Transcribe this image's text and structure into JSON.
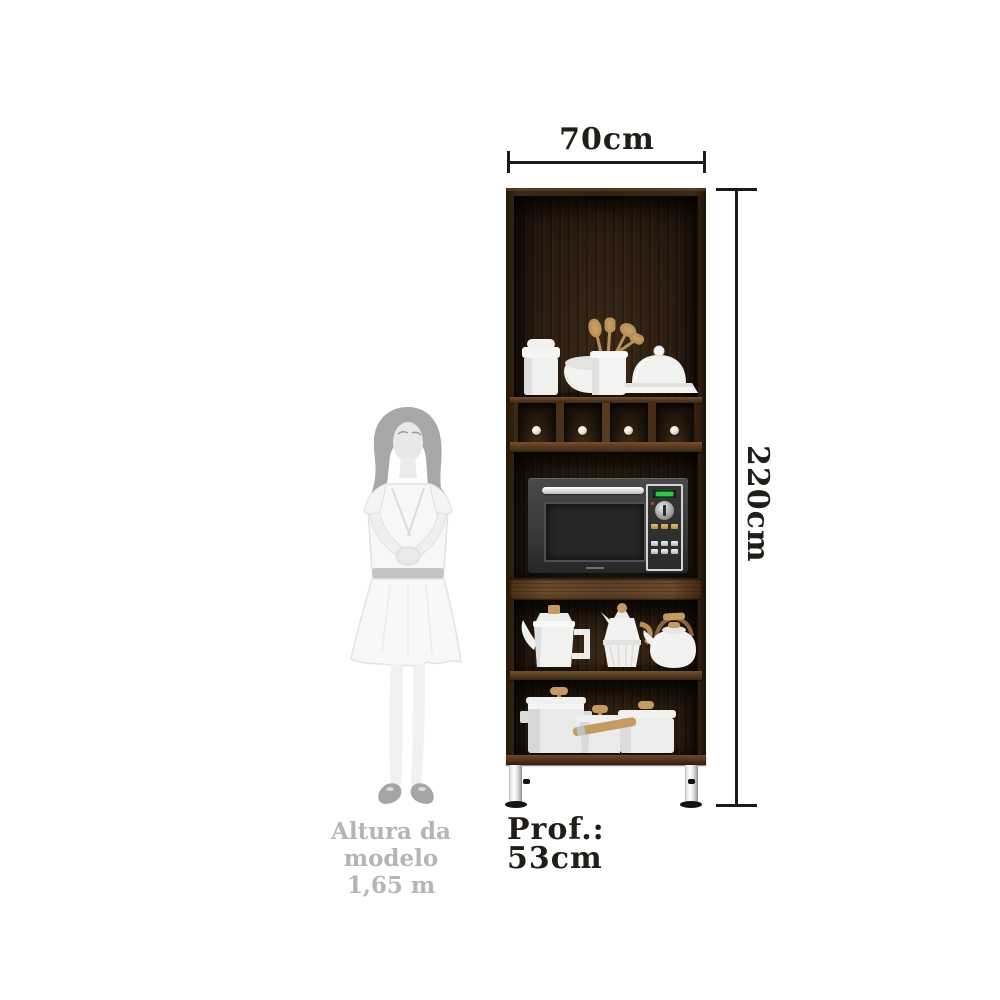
{
  "annotations": {
    "width_label": "70cm",
    "height_label": "220cm",
    "depth_label": "Prof.:",
    "depth_value": "53cm"
  },
  "model": {
    "caption_line1": "Altura da modelo",
    "caption_line2": "1,65 m"
  },
  "cabinet": {
    "cubby_knob_count": 4,
    "top_shelf_items": [
      "ceramic-canister",
      "ceramic-bowl",
      "utensil-crock-with-wooden-utensils",
      "butter-dish"
    ],
    "middle_item": "microwave-oven",
    "tea_shelf_items": [
      "coffee-pot",
      "moka-pot",
      "kettle"
    ],
    "bottom_shelf_items": [
      "stockpot",
      "casserole",
      "saucepan-with-wooden-handle"
    ]
  },
  "palette": {
    "text_dark": "#211d19",
    "text_gray": "#b7b5b2",
    "line": "#1d1a17",
    "wood_frame": "#31220f",
    "wood_interior": "#2a1c10",
    "wood_shelf": "#5d3f28",
    "metal_leg_dark": "#9c9c9c",
    "display_green": "#38c24e",
    "wood_accent": "#c49b63",
    "ceramic": "#efefed"
  }
}
